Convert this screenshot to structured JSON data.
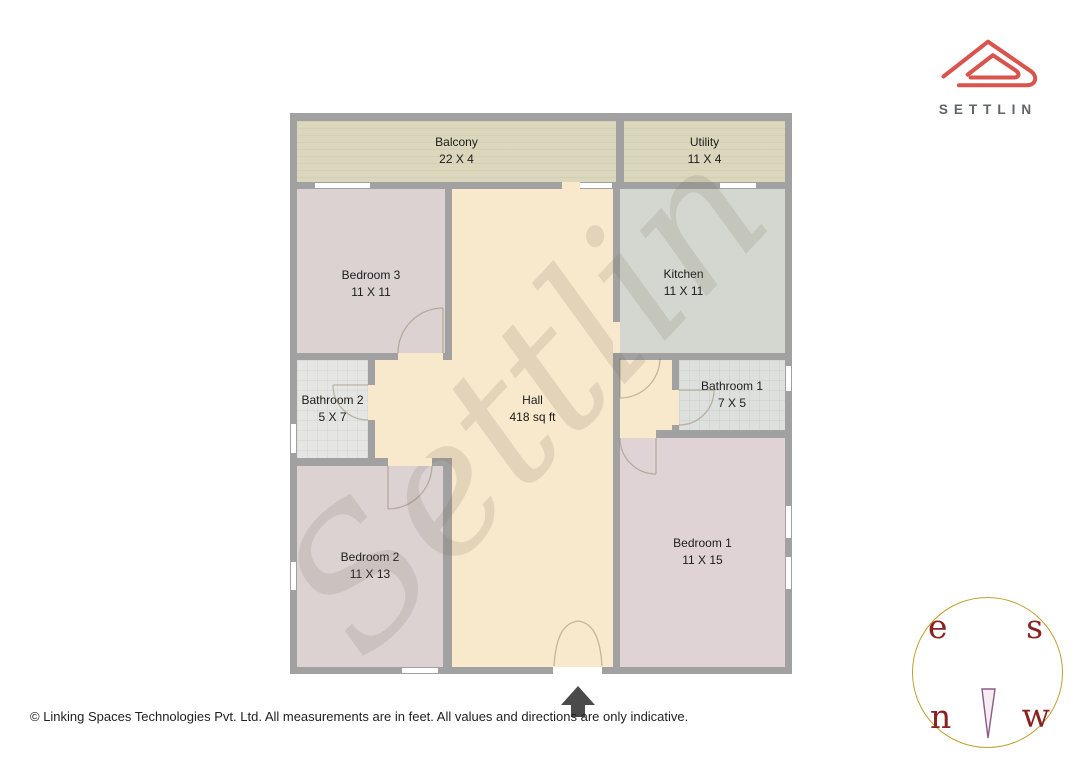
{
  "brand": {
    "name": "SETTLIN"
  },
  "watermark_text": "Settlin",
  "rooms": [
    {
      "name": "Balcony",
      "dims": "22 X 4"
    },
    {
      "name": "Utility",
      "dims": "11 X 4"
    },
    {
      "name": "Bedroom 3",
      "dims": "11 X 11"
    },
    {
      "name": "Kitchen",
      "dims": "11 X 11"
    },
    {
      "name": "Bathroom 2",
      "dims": "5 X 7"
    },
    {
      "name": "Hall",
      "dims": "418 sq ft"
    },
    {
      "name": "Bathroom 1",
      "dims": "7 X 5"
    },
    {
      "name": "Bedroom 2",
      "dims": "11 X 13"
    },
    {
      "name": "Bedroom 1",
      "dims": "11 X 15"
    }
  ],
  "compass": {
    "top_left": "e",
    "top_right": "s",
    "bottom_left": "n",
    "bottom_right": "w"
  },
  "footer": {
    "copyright": "© Linking Spaces Technologies Pvt. Ltd. All measurements are in feet. All values and directions are only indicative."
  },
  "palette": {
    "wall": "#a1a1a1",
    "balcony": "#dbd7bd",
    "utility": "#dbd7bd",
    "bedroom3": "#ddd2d2",
    "bedroom2": "#ddd2d2",
    "bedroom1": "#e0d3d5",
    "kitchen": "#d4d7cf",
    "bathroom2": "#e5e6e3",
    "bathroom1": "#dee0de",
    "hall": "#f8e8cc",
    "window": "#ffffff",
    "brand_red": "#d9544d",
    "brand_text": "#5f6468",
    "compass_ring": "#c19f2f",
    "compass_letters": "#8b2121",
    "entrance_arrow": "#4a4a4a"
  }
}
